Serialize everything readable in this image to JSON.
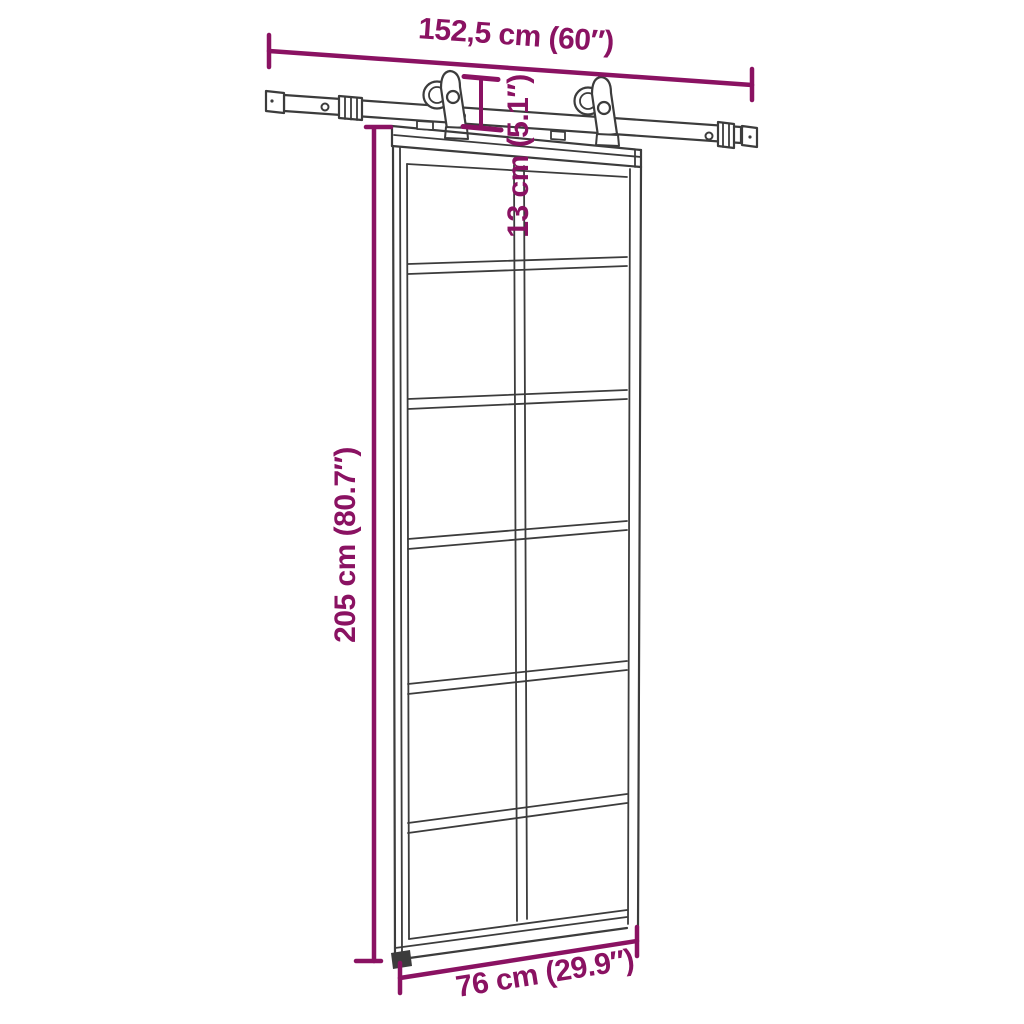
{
  "diagram": {
    "colors": {
      "annotation": "#8A1262",
      "line_art": "#3C3C3C",
      "background": "#FFFFFF"
    },
    "annotations": {
      "rail_width": "152,5 cm (60″)",
      "top_offset": "13 cm (5.1″)",
      "door_height": "205 cm (80.7″)",
      "door_width": "76 cm (29.9″)"
    }
  }
}
